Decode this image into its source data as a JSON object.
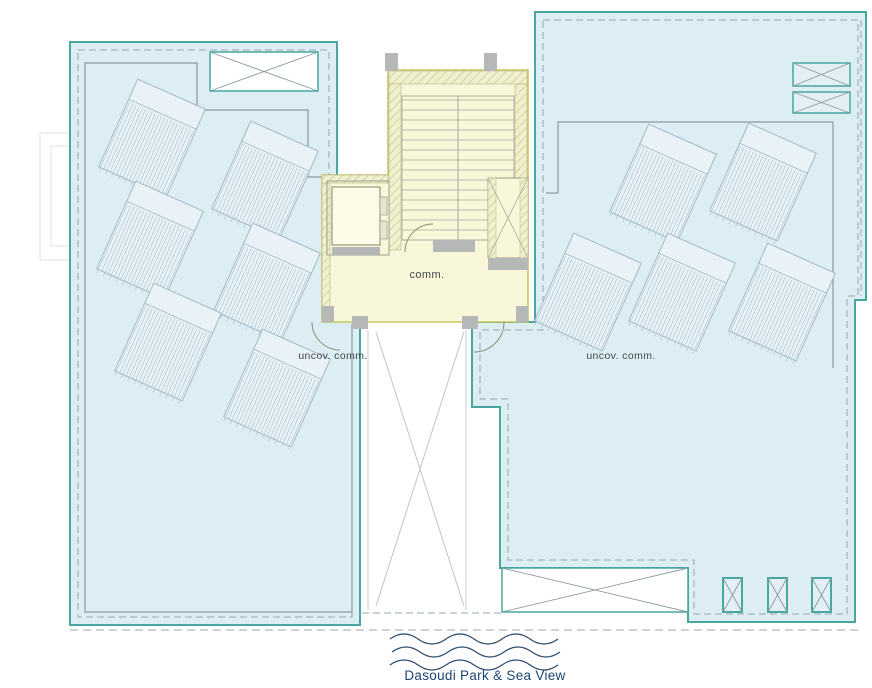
{
  "plan": {
    "labels": {
      "core_label": "comm.",
      "left_terrace_label": "uncov. comm.",
      "right_terrace_label": "uncov. comm.",
      "caption": "Dasoudi Park & Sea View"
    },
    "colors": {
      "terrace_fill": "#dcedf3",
      "terrace_border": "#49a79f",
      "core_fill": "#f8f7d9",
      "core_border": "#c3c85d",
      "line_grey": "#8b99a1",
      "dash_grey": "#9aa7ae",
      "panel_fill": "#e8f2f7",
      "panel_stroke": "#a2b8c4",
      "panel_line": "#afc5d1",
      "vent_fill": "#e2eff4",
      "wall_grey": "#b6b8b8",
      "stair_line": "#a8a89a",
      "wave_color": "#2b4a6e",
      "caption_color": "#1d4470",
      "label_color": "#43474b"
    },
    "solar_panels": {
      "rotation_deg": 24,
      "width": 74,
      "height": 96,
      "header_depth": 22,
      "stripe_step": 3.5,
      "left_terrace": [
        {
          "x": 152,
          "y": 138
        },
        {
          "x": 265,
          "y": 180
        },
        {
          "x": 150,
          "y": 240
        },
        {
          "x": 267,
          "y": 282
        },
        {
          "x": 168,
          "y": 342
        },
        {
          "x": 277,
          "y": 388
        }
      ],
      "right_terrace": [
        {
          "x": 663,
          "y": 183
        },
        {
          "x": 763,
          "y": 182
        },
        {
          "x": 588,
          "y": 292
        },
        {
          "x": 682,
          "y": 292
        },
        {
          "x": 782,
          "y": 302
        }
      ]
    },
    "roof_vents": [
      {
        "x": 210,
        "y": 52,
        "w": 108,
        "h": 39,
        "style": "white"
      },
      {
        "x": 793,
        "y": 63,
        "w": 57,
        "h": 23,
        "style": "blue"
      },
      {
        "x": 793,
        "y": 92,
        "w": 57,
        "h": 21,
        "style": "blue"
      },
      {
        "x": 502,
        "y": 568,
        "w": 186,
        "h": 44,
        "style": "white"
      },
      {
        "x": 723,
        "y": 578,
        "w": 19,
        "h": 34,
        "style": "blue"
      },
      {
        "x": 768,
        "y": 578,
        "w": 19,
        "h": 34,
        "style": "blue"
      },
      {
        "x": 812,
        "y": 578,
        "w": 19,
        "h": 34,
        "style": "blue"
      }
    ]
  }
}
